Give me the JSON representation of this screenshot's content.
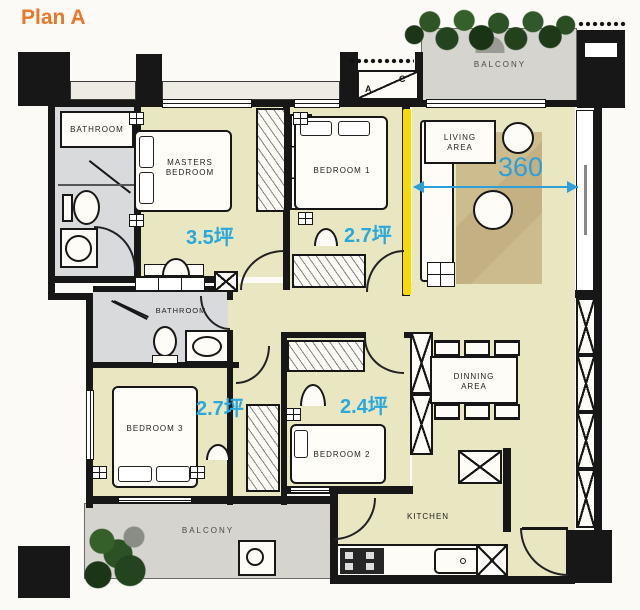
{
  "title": "Plan A",
  "rooms": {
    "bathroom_top": {
      "label": "BATHROOM"
    },
    "masters_bedroom": {
      "label": "MASTERS BEDROOM",
      "area": "3.5坪"
    },
    "bedroom1": {
      "label": "BEDROOM 1",
      "area": "2.7坪"
    },
    "living": {
      "label": "LIVING AREA"
    },
    "balcony_top": {
      "label": "BALCONY"
    },
    "bathroom_mid": {
      "label": "BATHROOM"
    },
    "bedroom3": {
      "label": "BEDROOM 3",
      "area": "2.7坪"
    },
    "bedroom2": {
      "label": "BEDROOM 2",
      "area": "2.4坪"
    },
    "dining": {
      "label": "DINNING AREA"
    },
    "kitchen": {
      "label": "KITCHEN"
    },
    "balcony_bottom": {
      "label": "BALCONY"
    }
  },
  "dimension": {
    "value": "360"
  },
  "ac_unit": {
    "letter_a": "A",
    "letter_c": "C"
  },
  "colors": {
    "accent_orange": "#e8772a",
    "area_blue": "#29a8dc",
    "dimension_blue": "#2f9fd8",
    "highlight_yellow": "#f8da00",
    "wall_black": "#171717",
    "floor_yellow": "#e9e6c2",
    "floor_gray": "#d8dadb",
    "balcony_gray": "#d5d4cf",
    "rug_tan": "#c8b888",
    "plant_green": "#2c5124"
  }
}
